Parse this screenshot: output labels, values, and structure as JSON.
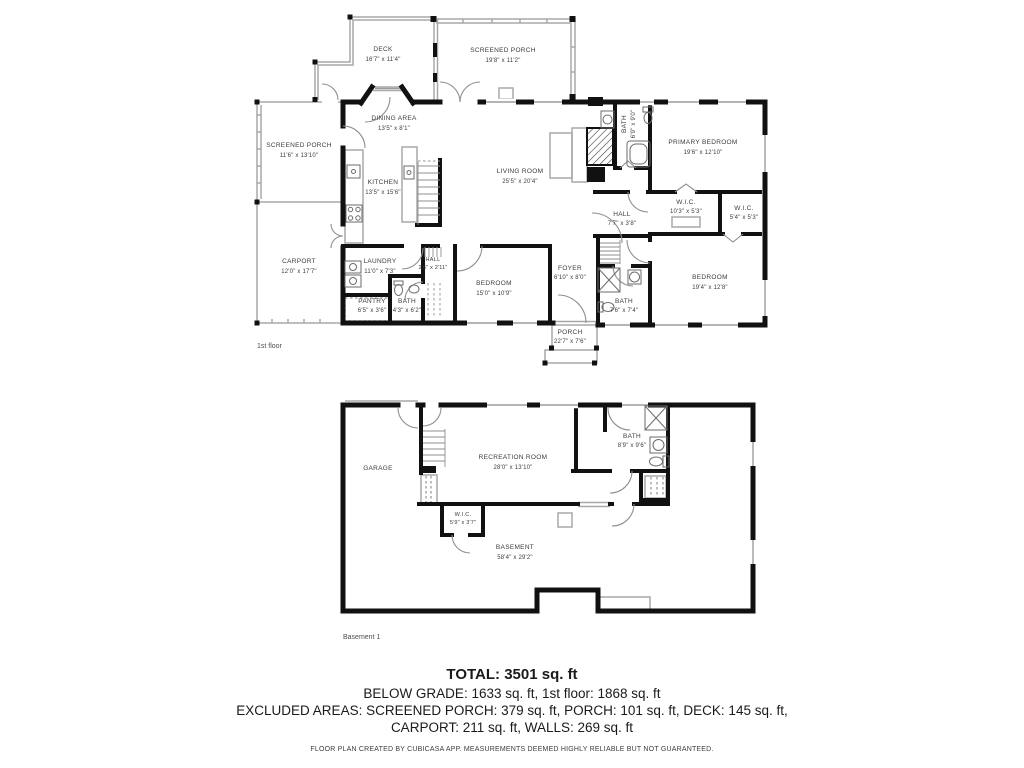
{
  "colors": {
    "walls": "#111111",
    "thin_lines": "#a8a8a8",
    "label_text": "#3c3c3c"
  },
  "floor1": {
    "floor_label": "1st floor",
    "rooms": {
      "deck": {
        "name": "DECK",
        "dims": "16'7\" x 11'4\""
      },
      "screened_porch_top": {
        "name": "SCREENED PORCH",
        "dims": "19'8\" x 11'2\""
      },
      "screened_porch_left": {
        "name": "SCREENED PORCH",
        "dims": "11'6\" x 13'10\""
      },
      "dining": {
        "name": "DINING AREA",
        "dims": "13'5\" x 8'1\""
      },
      "kitchen": {
        "name": "KITCHEN",
        "dims": "13'5\" x 15'6\""
      },
      "living": {
        "name": "LIVING ROOM",
        "dims": "25'5\" x 20'4\""
      },
      "primary_bath": {
        "name": "BATH",
        "dims": "6'9\" x 9'0\""
      },
      "primary_bedroom": {
        "name": "PRIMARY BEDROOM",
        "dims": "19'6\" x 12'10\""
      },
      "wic1": {
        "name": "W.I.C.",
        "dims": "10'3\" x 5'3\""
      },
      "wic2": {
        "name": "W.I.C.",
        "dims": "5'4\" x 5'3\""
      },
      "hall1": {
        "name": "HALL",
        "dims": "7'7\" x 3'8\""
      },
      "carport": {
        "name": "CARPORT",
        "dims": "12'0\" x 17'7\""
      },
      "laundry": {
        "name": "LAUNDRY",
        "dims": "11'0\" x 7'3\""
      },
      "hall2": {
        "name": "HALL",
        "dims": "2'6\" x 2'11\""
      },
      "pantry": {
        "name": "PANTRY",
        "dims": "6'5\" x 3'6\""
      },
      "bath2": {
        "name": "BATH",
        "dims": "4'3\" x 6'2\""
      },
      "bedroom1": {
        "name": "BEDROOM",
        "dims": "15'0\" x 10'9\""
      },
      "foyer": {
        "name": "FOYER",
        "dims": "6'10\" x 8'0\""
      },
      "bath3": {
        "name": "BATH",
        "dims": "7'6\" x 7'4\""
      },
      "bedroom2": {
        "name": "BEDROOM",
        "dims": "19'4\" x 12'8\""
      },
      "porch": {
        "name": "PORCH",
        "dims": "22'7\" x 7'6\""
      }
    }
  },
  "basement": {
    "floor_label": "Basement 1",
    "rooms": {
      "garage": {
        "name": "GARAGE"
      },
      "recreation": {
        "name": "RECREATION ROOM",
        "dims": "28'0\" x 13'10\""
      },
      "bath": {
        "name": "BATH",
        "dims": "8'9\" x 9'6\""
      },
      "wic": {
        "name": "W.I.C.",
        "dims": "5'9\" x 3'7\""
      },
      "basement": {
        "name": "BASEMENT",
        "dims": "58'4\" x 29'2\""
      }
    }
  },
  "summary": {
    "total": "TOTAL: 3501 sq. ft",
    "below_grade": "BELOW GRADE: 1633 sq. ft, 1st floor: 1868 sq. ft",
    "excluded_1": "EXCLUDED AREAS: SCREENED PORCH: 379 sq. ft, PORCH: 101 sq. ft, DECK: 145 sq. ft,",
    "excluded_2": "CARPORT: 211 sq. ft, WALLS: 269 sq. ft",
    "disclaimer": "FLOOR PLAN CREATED BY CUBICASA APP. MEASUREMENTS DEEMED HIGHLY RELIABLE BUT NOT GUARANTEED."
  }
}
